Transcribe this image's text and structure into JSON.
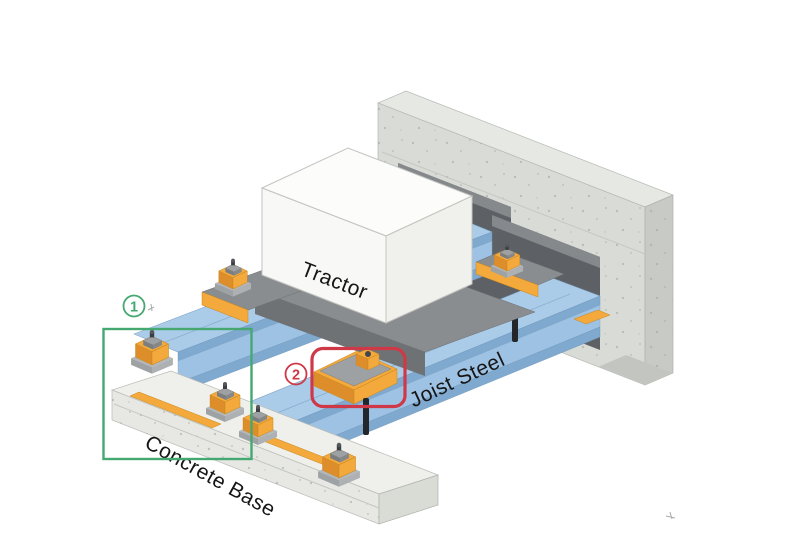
{
  "diagram": {
    "labels": {
      "machine": "Tractor",
      "beam": "Joist Steel",
      "foundation": "Concrete Base"
    },
    "callouts": {
      "c1": {
        "number": "1"
      },
      "c2": {
        "number": "2"
      }
    },
    "colors": {
      "joist_blue": "#aacce9",
      "joist_blue_edge": "#7fa9cf",
      "joist_blue_web": "#9ec2e3",
      "isolator_orange": "#f3a93c",
      "isolator_orange_dark": "#dd8e2a",
      "cap_gray": "#9ea1a3",
      "cap_gray_dark": "#85888a",
      "platform_gray": "#8a8d8f",
      "platform_gray_dark": "#6f7274",
      "wall_face": "#d9dbd7",
      "wall_top": "#e6e8e4",
      "wall_side": "#c7cac5",
      "wall_bottom": "#c2c5c0",
      "opening_dark": "#5d6165",
      "sleeve_gray": "#85898c",
      "base_top": "#eff0ec",
      "base_face": "#e7e8e4",
      "base_side": "#d9dbd5",
      "white_box_top": "#fcfcfa",
      "white_box_front": "#f8f8f6",
      "white_box_side": "#f0f0ed",
      "callout_green": "#46a871",
      "callout_red": "#ce3847",
      "label_ink": "#161616",
      "rod_black": "#23272b"
    }
  }
}
